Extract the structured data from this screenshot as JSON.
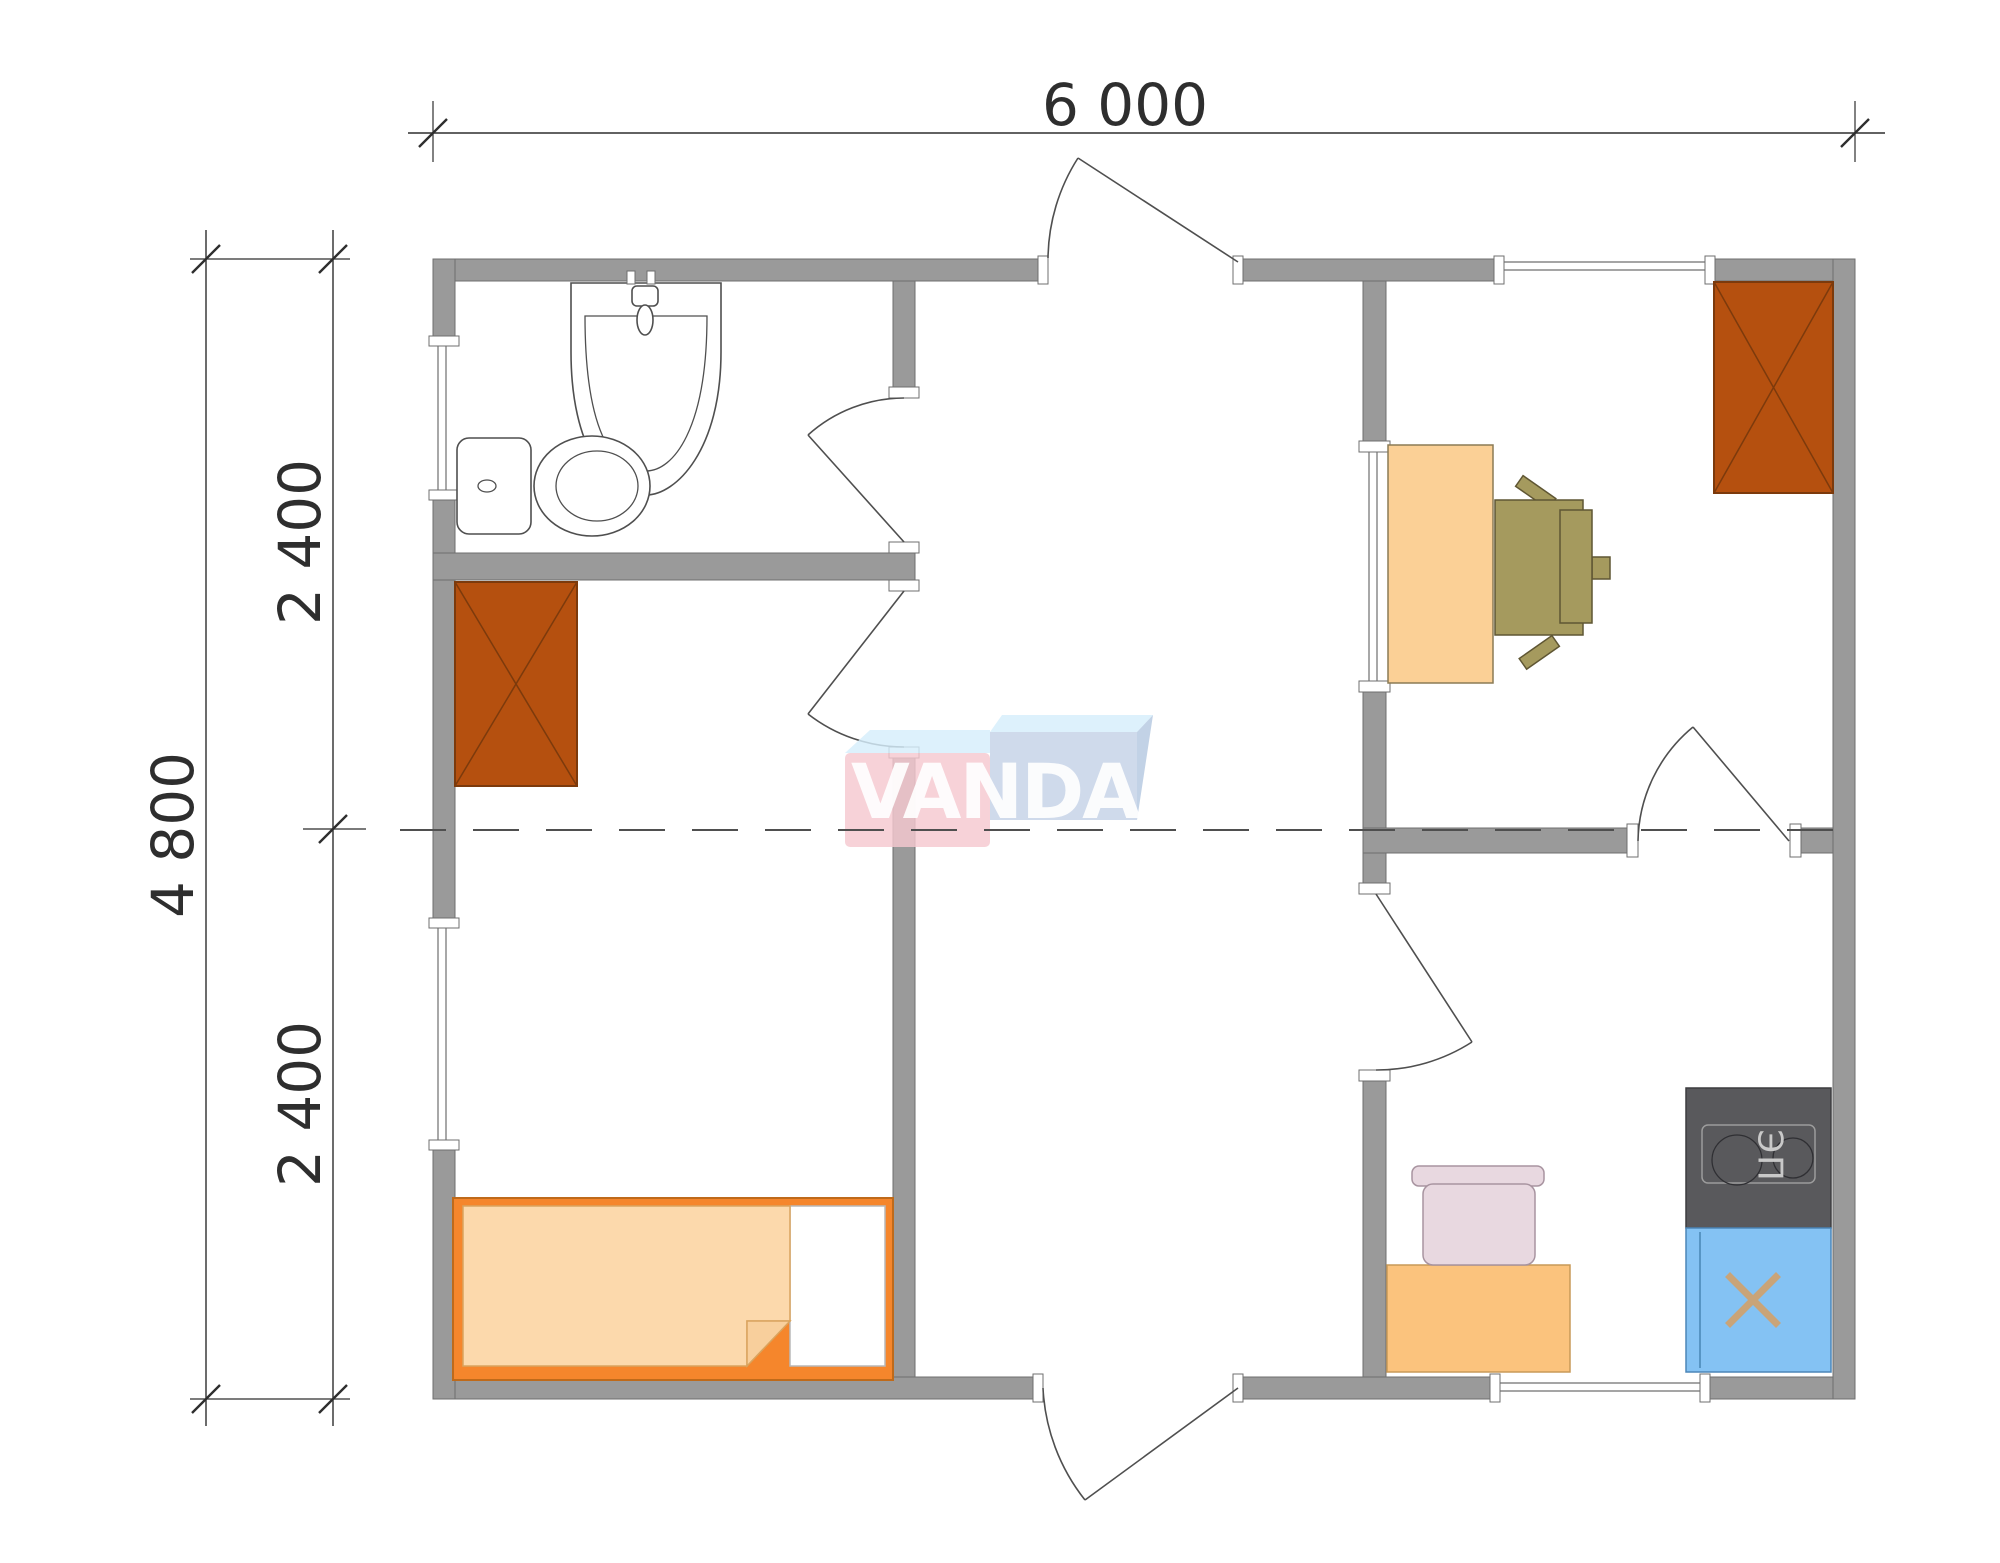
{
  "dimensions": {
    "top_width": "6 000",
    "left_total": "4 800",
    "left_upper": "2 400",
    "left_lower": "2 400"
  },
  "stove": {
    "label": "ЭП"
  },
  "logo": {
    "text": "VANDA"
  },
  "colors": {
    "wall": "#9a9a9a",
    "wall-stroke": "#6f6f6f",
    "line": "#4f4f4f",
    "dim": "#2e2e2e",
    "wardrobe": "#b5500f",
    "wardrobe-stroke": "#7c3a0c",
    "desk": "#fbd096",
    "desk-stroke": "#8b7b55",
    "chair-olive": "#a59a5e",
    "chair-olive-stroke": "#5f5633",
    "bed-frame": "#f5862c",
    "bed-frame-stroke": "#bf6a1a",
    "blanket": "#fcd9ac",
    "cabinet": "#fbc37d",
    "chair-pink": "#e8d8e0",
    "chair-pink-stroke": "#a894a0",
    "stove-body": "#59595c",
    "stove-line": "#9c9c9c",
    "stove-text": "#c9c9c9",
    "sink-blue": "#84c2f3",
    "sink-x": "#c9a478",
    "logo-pink": "#f5c8cf",
    "logo-blue": "#c4d2e6",
    "logo-flap": "#d6eefb",
    "logo-side": "#b5c8e0"
  }
}
